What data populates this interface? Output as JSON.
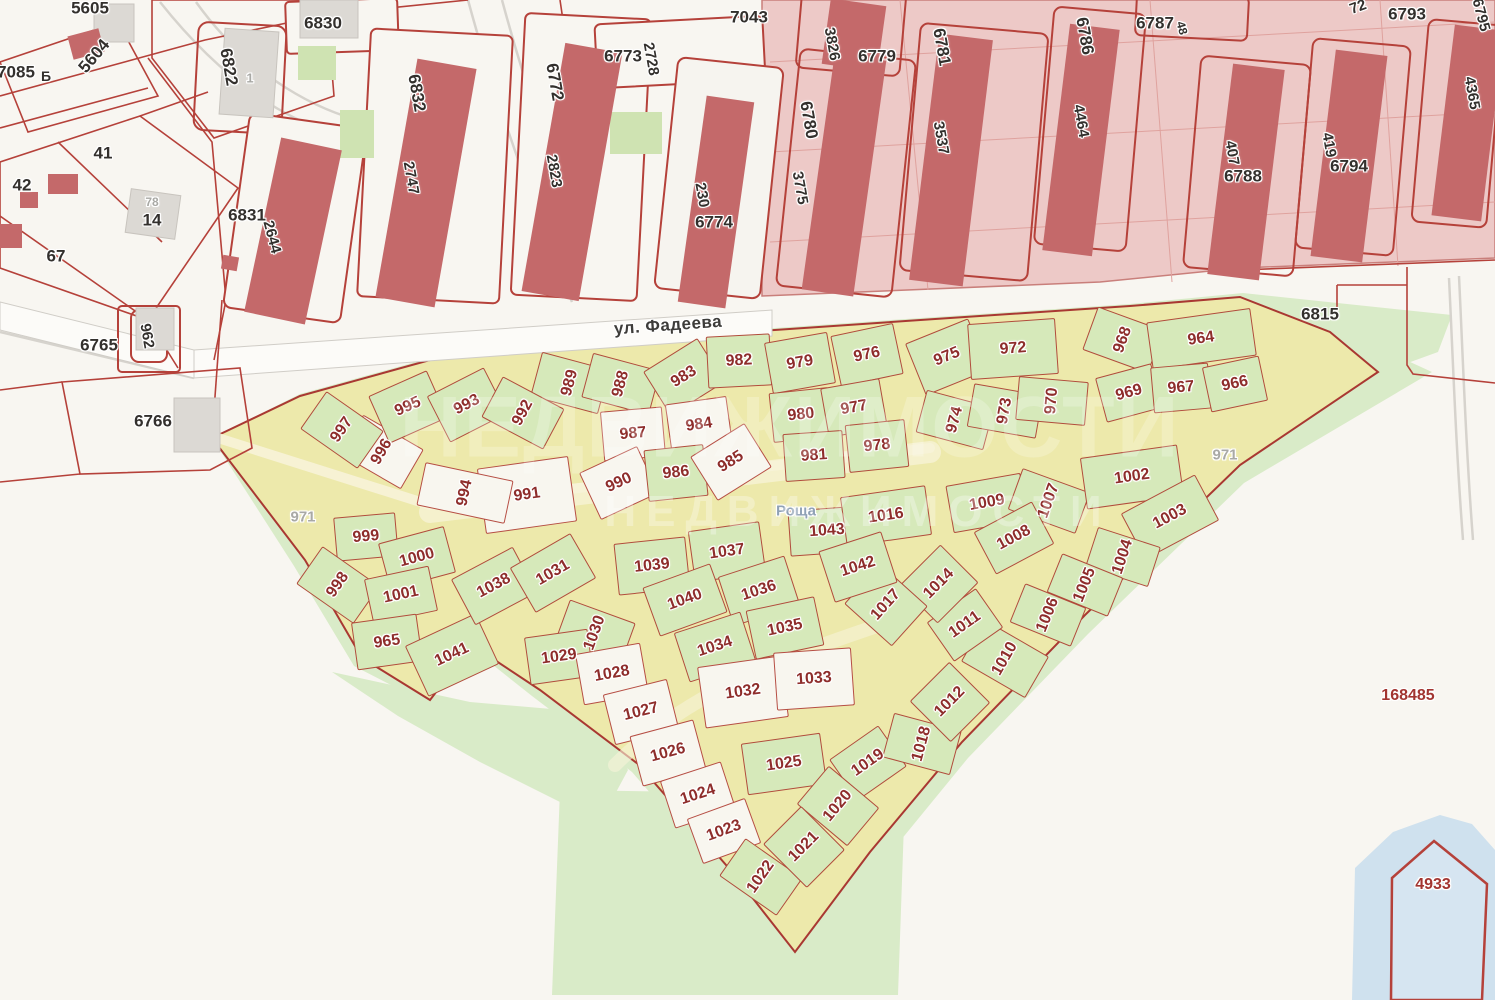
{
  "colors": {
    "background": "#f8f6f1",
    "district_pink": "#edc9c7",
    "building_red": "#c4696a",
    "boundary_red": "#b5413a",
    "quarter_yellow": "#ede9ab",
    "plot_green": "#d6e9ba",
    "plot_white": "#f8f6ef",
    "open_green": "#d9ebc8",
    "water_blue": "#cfe1ee",
    "plot_number_red": "#8e2d2b",
    "block_number_black": "#33302d",
    "muted_gray": "#a9a9a5"
  },
  "street": {
    "name": "ул. Фадеева"
  },
  "forest": {
    "name": "Роща"
  },
  "watermark": {
    "text": "НЕДВИЖИМОСТИ"
  },
  "reference_numbers": {
    "district": "168485",
    "water_parcel": "4933"
  },
  "labels": [
    {
      "t": "5605",
      "x": 90,
      "y": 8,
      "r": 0,
      "k": "b"
    },
    {
      "t": "5604",
      "x": 94,
      "y": 56,
      "r": -50,
      "k": "b"
    },
    {
      "t": "7085",
      "x": 16,
      "y": 72,
      "r": 0,
      "k": "b"
    },
    {
      "t": "Б",
      "x": 46,
      "y": 76,
      "r": 0,
      "k": "b",
      "fs": 14
    },
    {
      "t": "41",
      "x": 103,
      "y": 153,
      "r": 0,
      "k": "b"
    },
    {
      "t": "42",
      "x": 22,
      "y": 185,
      "r": 0,
      "k": "b"
    },
    {
      "t": "78",
      "x": 152,
      "y": 202,
      "r": 0,
      "k": "g",
      "fs": 12
    },
    {
      "t": "14",
      "x": 152,
      "y": 220,
      "r": 0,
      "k": "b"
    },
    {
      "t": "67",
      "x": 56,
      "y": 256,
      "r": 0,
      "k": "b"
    },
    {
      "t": "6822",
      "x": 229,
      "y": 67,
      "r": 80,
      "k": "b"
    },
    {
      "t": "1",
      "x": 250,
      "y": 78,
      "r": 0,
      "k": "g",
      "fs": 13
    },
    {
      "t": "6830",
      "x": 323,
      "y": 23,
      "r": 0,
      "k": "b"
    },
    {
      "t": "6831",
      "x": 247,
      "y": 215,
      "r": 0,
      "k": "b"
    },
    {
      "t": "2644",
      "x": 272,
      "y": 237,
      "r": 75,
      "k": "b",
      "fs": 15
    },
    {
      "t": "6832",
      "x": 417,
      "y": 93,
      "r": 80,
      "k": "b"
    },
    {
      "t": "2747",
      "x": 411,
      "y": 178,
      "r": 80,
      "k": "b",
      "fs": 15
    },
    {
      "t": "6772",
      "x": 555,
      "y": 82,
      "r": 80,
      "k": "b"
    },
    {
      "t": "2823",
      "x": 554,
      "y": 171,
      "r": 80,
      "k": "b",
      "fs": 15
    },
    {
      "t": "6773",
      "x": 623,
      "y": 56,
      "r": 0,
      "k": "b"
    },
    {
      "t": "2728",
      "x": 651,
      "y": 59,
      "r": 80,
      "k": "b",
      "fs": 15
    },
    {
      "t": "7043",
      "x": 749,
      "y": 17,
      "r": 0,
      "k": "b"
    },
    {
      "t": "3826",
      "x": 832,
      "y": 44,
      "r": 80,
      "k": "b",
      "fs": 15
    },
    {
      "t": "6779",
      "x": 877,
      "y": 56,
      "r": 0,
      "k": "b"
    },
    {
      "t": "6780",
      "x": 809,
      "y": 120,
      "r": 80,
      "k": "b"
    },
    {
      "t": "3775",
      "x": 800,
      "y": 188,
      "r": 80,
      "k": "b",
      "fs": 15
    },
    {
      "t": "6781",
      "x": 942,
      "y": 47,
      "r": 80,
      "k": "b"
    },
    {
      "t": "3537",
      "x": 941,
      "y": 138,
      "r": 80,
      "k": "b",
      "fs": 15
    },
    {
      "t": "6786",
      "x": 1085,
      "y": 36,
      "r": 80,
      "k": "b"
    },
    {
      "t": "4464",
      "x": 1081,
      "y": 121,
      "r": 80,
      "k": "b",
      "fs": 15
    },
    {
      "t": "6787",
      "x": 1155,
      "y": 23,
      "r": 0,
      "k": "b"
    },
    {
      "t": "48",
      "x": 1182,
      "y": 28,
      "r": 75,
      "k": "b",
      "fs": 12
    },
    {
      "t": "6788",
      "x": 1243,
      "y": 176,
      "r": 0,
      "k": "b"
    },
    {
      "t": "407",
      "x": 1232,
      "y": 153,
      "r": 80,
      "k": "b",
      "fs": 15
    },
    {
      "t": "6793",
      "x": 1407,
      "y": 14,
      "r": 0,
      "k": "b"
    },
    {
      "t": "72",
      "x": 1358,
      "y": 7,
      "r": -20,
      "k": "b",
      "fs": 15
    },
    {
      "t": "6794",
      "x": 1349,
      "y": 166,
      "r": 0,
      "k": "b"
    },
    {
      "t": "419",
      "x": 1329,
      "y": 145,
      "r": 80,
      "k": "b",
      "fs": 15
    },
    {
      "t": "4365",
      "x": 1472,
      "y": 93,
      "r": 80,
      "k": "b",
      "fs": 15
    },
    {
      "t": "6795",
      "x": 1481,
      "y": 15,
      "r": 75,
      "k": "b",
      "fs": 15
    },
    {
      "t": "230",
      "x": 702,
      "y": 195,
      "r": 80,
      "k": "b",
      "fs": 15
    },
    {
      "t": "6774",
      "x": 714,
      "y": 222,
      "r": 0,
      "k": "b"
    },
    {
      "t": "6765",
      "x": 99,
      "y": 345,
      "r": 0,
      "k": "b"
    },
    {
      "t": "962",
      "x": 147,
      "y": 336,
      "r": 80,
      "k": "b",
      "fs": 15
    },
    {
      "t": "6766",
      "x": 153,
      "y": 421,
      "r": 0,
      "k": "b"
    },
    {
      "t": "6815",
      "x": 1320,
      "y": 314,
      "r": 0,
      "k": "b"
    },
    {
      "t": "ул. Фадеева",
      "x": 668,
      "y": 325,
      "r": -4,
      "k": "s"
    },
    {
      "t": "Роща",
      "x": 796,
      "y": 511,
      "r": 0,
      "k": "f"
    },
    {
      "t": "971",
      "x": 303,
      "y": 517,
      "r": 0,
      "k": "g"
    },
    {
      "t": "971",
      "x": 1225,
      "y": 455,
      "r": 0,
      "k": "g"
    },
    {
      "t": "168485",
      "x": 1408,
      "y": 696,
      "r": 0,
      "k": "r"
    },
    {
      "t": "4933",
      "x": 1433,
      "y": 885,
      "r": 0,
      "k": "r"
    },
    {
      "t": "989",
      "x": 570,
      "y": 383,
      "r": -75,
      "k": "p"
    },
    {
      "t": "988",
      "x": 621,
      "y": 384,
      "r": -75,
      "k": "p"
    },
    {
      "t": "983",
      "x": 684,
      "y": 377,
      "r": -32,
      "k": "p"
    },
    {
      "t": "982",
      "x": 739,
      "y": 361,
      "r": -3,
      "k": "p"
    },
    {
      "t": "979",
      "x": 800,
      "y": 363,
      "r": -10,
      "k": "p"
    },
    {
      "t": "976",
      "x": 867,
      "y": 355,
      "r": -12,
      "k": "p"
    },
    {
      "t": "975",
      "x": 947,
      "y": 357,
      "r": -22,
      "k": "p",
      "cw": 68,
      "ch": 56
    },
    {
      "t": "972",
      "x": 1013,
      "y": 349,
      "r": -4,
      "k": "p",
      "cw": 88,
      "ch": 56
    },
    {
      "t": "968",
      "x": 1123,
      "y": 340,
      "r": -70,
      "k": "p"
    },
    {
      "t": "964",
      "x": 1201,
      "y": 339,
      "r": -8,
      "k": "p",
      "cw": 105,
      "ch": 48
    },
    {
      "t": "969",
      "x": 1129,
      "y": 393,
      "r": -15,
      "k": "p",
      "cw": 58,
      "ch": 46
    },
    {
      "t": "967",
      "x": 1181,
      "y": 388,
      "r": -5,
      "k": "p",
      "cw": 58,
      "ch": 46
    },
    {
      "t": "966",
      "x": 1235,
      "y": 384,
      "r": -12,
      "k": "p",
      "cw": 58,
      "ch": 46
    },
    {
      "t": "974",
      "x": 955,
      "y": 420,
      "r": -75,
      "k": "p",
      "cw": 44,
      "ch": 70
    },
    {
      "t": "973",
      "x": 1005,
      "y": 411,
      "r": -80,
      "k": "p",
      "cw": 44,
      "ch": 70
    },
    {
      "t": "970",
      "x": 1052,
      "y": 401,
      "r": -85,
      "k": "p",
      "cw": 44,
      "ch": 70
    },
    {
      "t": "980",
      "x": 801,
      "y": 415,
      "r": -6,
      "k": "p",
      "cw": 60,
      "ch": 50
    },
    {
      "t": "977",
      "x": 854,
      "y": 408,
      "r": -10,
      "k": "p",
      "cw": 60,
      "ch": 50
    },
    {
      "t": "987",
      "x": 633,
      "y": 434,
      "r": -5,
      "k": "w",
      "cw": 62,
      "ch": 50
    },
    {
      "t": "984",
      "x": 699,
      "y": 425,
      "r": -8,
      "k": "w",
      "cw": 62,
      "ch": 50
    },
    {
      "t": "981",
      "x": 814,
      "y": 456,
      "r": -4,
      "k": "p",
      "cw": 60,
      "ch": 48
    },
    {
      "t": "978",
      "x": 877,
      "y": 446,
      "r": -6,
      "k": "p",
      "cw": 60,
      "ch": 48
    },
    {
      "t": "990",
      "x": 619,
      "y": 483,
      "r": -25,
      "k": "w"
    },
    {
      "t": "986",
      "x": 676,
      "y": 473,
      "r": -6,
      "k": "p",
      "cw": 60,
      "ch": 52
    },
    {
      "t": "985",
      "x": 731,
      "y": 462,
      "r": -32,
      "k": "w"
    },
    {
      "t": "991",
      "x": 527,
      "y": 495,
      "r": -8,
      "k": "w",
      "cw": 92,
      "ch": 66
    },
    {
      "t": "994",
      "x": 465,
      "y": 493,
      "r": -78,
      "k": "w",
      "cw": 44,
      "ch": 90
    },
    {
      "t": "996",
      "x": 382,
      "y": 452,
      "r": -60,
      "k": "w"
    },
    {
      "t": "997",
      "x": 342,
      "y": 430,
      "r": -55,
      "k": "p"
    },
    {
      "t": "995",
      "x": 408,
      "y": 407,
      "r": -24,
      "k": "p"
    },
    {
      "t": "993",
      "x": 467,
      "y": 405,
      "r": -27,
      "k": "p"
    },
    {
      "t": "992",
      "x": 523,
      "y": 413,
      "r": -62,
      "k": "p"
    },
    {
      "t": "999",
      "x": 366,
      "y": 537,
      "r": -5,
      "k": "p",
      "cw": 62,
      "ch": 44
    },
    {
      "t": "1000",
      "x": 417,
      "y": 558,
      "r": -15,
      "k": "p",
      "cw": 68,
      "ch": 48
    },
    {
      "t": "998",
      "x": 338,
      "y": 585,
      "r": -55,
      "k": "p"
    },
    {
      "t": "1001",
      "x": 401,
      "y": 595,
      "r": -12,
      "k": "p",
      "cw": 66,
      "ch": 46
    },
    {
      "t": "965",
      "x": 387,
      "y": 642,
      "r": -8,
      "k": "p",
      "cw": 66,
      "ch": 48
    },
    {
      "t": "1041",
      "x": 452,
      "y": 655,
      "r": -25,
      "k": "p",
      "cw": 78,
      "ch": 56
    },
    {
      "t": "1038",
      "x": 494,
      "y": 586,
      "r": -28,
      "k": "p",
      "cw": 70,
      "ch": 52
    },
    {
      "t": "1031",
      "x": 553,
      "y": 573,
      "r": -30,
      "k": "p",
      "cw": 70,
      "ch": 52
    },
    {
      "t": "1030",
      "x": 595,
      "y": 633,
      "r": -70,
      "k": "p"
    },
    {
      "t": "1029",
      "x": 559,
      "y": 657,
      "r": -8,
      "k": "p",
      "cw": 64,
      "ch": 48
    },
    {
      "t": "1039",
      "x": 652,
      "y": 566,
      "r": -6,
      "k": "p",
      "cw": 72,
      "ch": 52
    },
    {
      "t": "1037",
      "x": 727,
      "y": 552,
      "r": -8,
      "k": "p",
      "cw": 72,
      "ch": 52
    },
    {
      "t": "1040",
      "x": 685,
      "y": 600,
      "r": -20,
      "k": "p",
      "cw": 72,
      "ch": 52
    },
    {
      "t": "1036",
      "x": 759,
      "y": 591,
      "r": -18,
      "k": "p",
      "cw": 70,
      "ch": 52
    },
    {
      "t": "1034",
      "x": 715,
      "y": 647,
      "r": -18,
      "k": "p",
      "cw": 70,
      "ch": 52
    },
    {
      "t": "1035",
      "x": 785,
      "y": 628,
      "r": -12,
      "k": "p",
      "cw": 70,
      "ch": 50
    },
    {
      "t": "1032",
      "x": 743,
      "y": 692,
      "r": -8,
      "k": "w",
      "cw": 84,
      "ch": 62
    },
    {
      "t": "1033",
      "x": 814,
      "y": 679,
      "r": -4,
      "k": "w",
      "cw": 78,
      "ch": 58
    },
    {
      "t": "1028",
      "x": 612,
      "y": 674,
      "r": -10,
      "k": "w",
      "cw": 66,
      "ch": 52
    },
    {
      "t": "1027",
      "x": 641,
      "y": 712,
      "r": -14,
      "k": "w",
      "cw": 66,
      "ch": 52
    },
    {
      "t": "1026",
      "x": 668,
      "y": 753,
      "r": -15,
      "k": "w",
      "cw": 66,
      "ch": 52
    },
    {
      "t": "1024",
      "x": 698,
      "y": 795,
      "r": -18,
      "k": "w",
      "cw": 64,
      "ch": 50
    },
    {
      "t": "1023",
      "x": 724,
      "y": 831,
      "r": -20,
      "k": "w",
      "cw": 62,
      "ch": 48
    },
    {
      "t": "1022",
      "x": 761,
      "y": 877,
      "r": -55,
      "k": "p"
    },
    {
      "t": "1025",
      "x": 784,
      "y": 764,
      "r": -8,
      "k": "p",
      "cw": 80,
      "ch": 52
    },
    {
      "t": "1019",
      "x": 868,
      "y": 763,
      "r": -35,
      "k": "p",
      "cw": 60,
      "ch": 50
    },
    {
      "t": "1020",
      "x": 838,
      "y": 806,
      "r": -50,
      "k": "p",
      "cw": 50,
      "ch": 66
    },
    {
      "t": "1021",
      "x": 804,
      "y": 847,
      "r": -45,
      "k": "p",
      "cw": 54,
      "ch": 62
    },
    {
      "t": "1018",
      "x": 922,
      "y": 744,
      "r": -75,
      "k": "p"
    },
    {
      "t": "1012",
      "x": 950,
      "y": 702,
      "r": -45,
      "k": "p",
      "cw": 56,
      "ch": 58
    },
    {
      "t": "1010",
      "x": 1005,
      "y": 659,
      "r": -60,
      "k": "p",
      "cw": 48,
      "ch": 74
    },
    {
      "t": "1011",
      "x": 965,
      "y": 625,
      "r": -35,
      "k": "p",
      "cw": 60,
      "ch": 48
    },
    {
      "t": "1014",
      "x": 939,
      "y": 584,
      "r": -45,
      "k": "p",
      "cw": 58,
      "ch": 54
    },
    {
      "t": "1017",
      "x": 886,
      "y": 605,
      "r": -48,
      "k": "p",
      "cw": 54,
      "ch": 64
    },
    {
      "t": "1043",
      "x": 827,
      "y": 531,
      "r": -4,
      "k": "p",
      "cw": 76,
      "ch": 46
    },
    {
      "t": "1016",
      "x": 886,
      "y": 516,
      "r": -8,
      "k": "p",
      "cw": 86,
      "ch": 50
    },
    {
      "t": "1042",
      "x": 858,
      "y": 567,
      "r": -18,
      "k": "p",
      "cw": 66,
      "ch": 54
    },
    {
      "t": "1009",
      "x": 987,
      "y": 503,
      "r": -10,
      "k": "p",
      "cw": 76,
      "ch": 48
    },
    {
      "t": "1007",
      "x": 1049,
      "y": 501,
      "r": -70,
      "k": "p",
      "cw": 44,
      "ch": 72
    },
    {
      "t": "1008",
      "x": 1014,
      "y": 538,
      "r": -28,
      "k": "p",
      "cw": 66,
      "ch": 48
    },
    {
      "t": "1002",
      "x": 1132,
      "y": 477,
      "r": -8,
      "k": "p",
      "cw": 98,
      "ch": 52
    },
    {
      "t": "1003",
      "x": 1170,
      "y": 517,
      "r": -28,
      "k": "p",
      "cw": 84,
      "ch": 52
    },
    {
      "t": "1004",
      "x": 1123,
      "y": 557,
      "r": -72,
      "k": "p",
      "cw": 42,
      "ch": 66
    },
    {
      "t": "1005",
      "x": 1085,
      "y": 585,
      "r": -68,
      "k": "p",
      "cw": 42,
      "ch": 66
    },
    {
      "t": "1006",
      "x": 1048,
      "y": 615,
      "r": -68,
      "k": "p",
      "cw": 42,
      "ch": 66
    }
  ]
}
